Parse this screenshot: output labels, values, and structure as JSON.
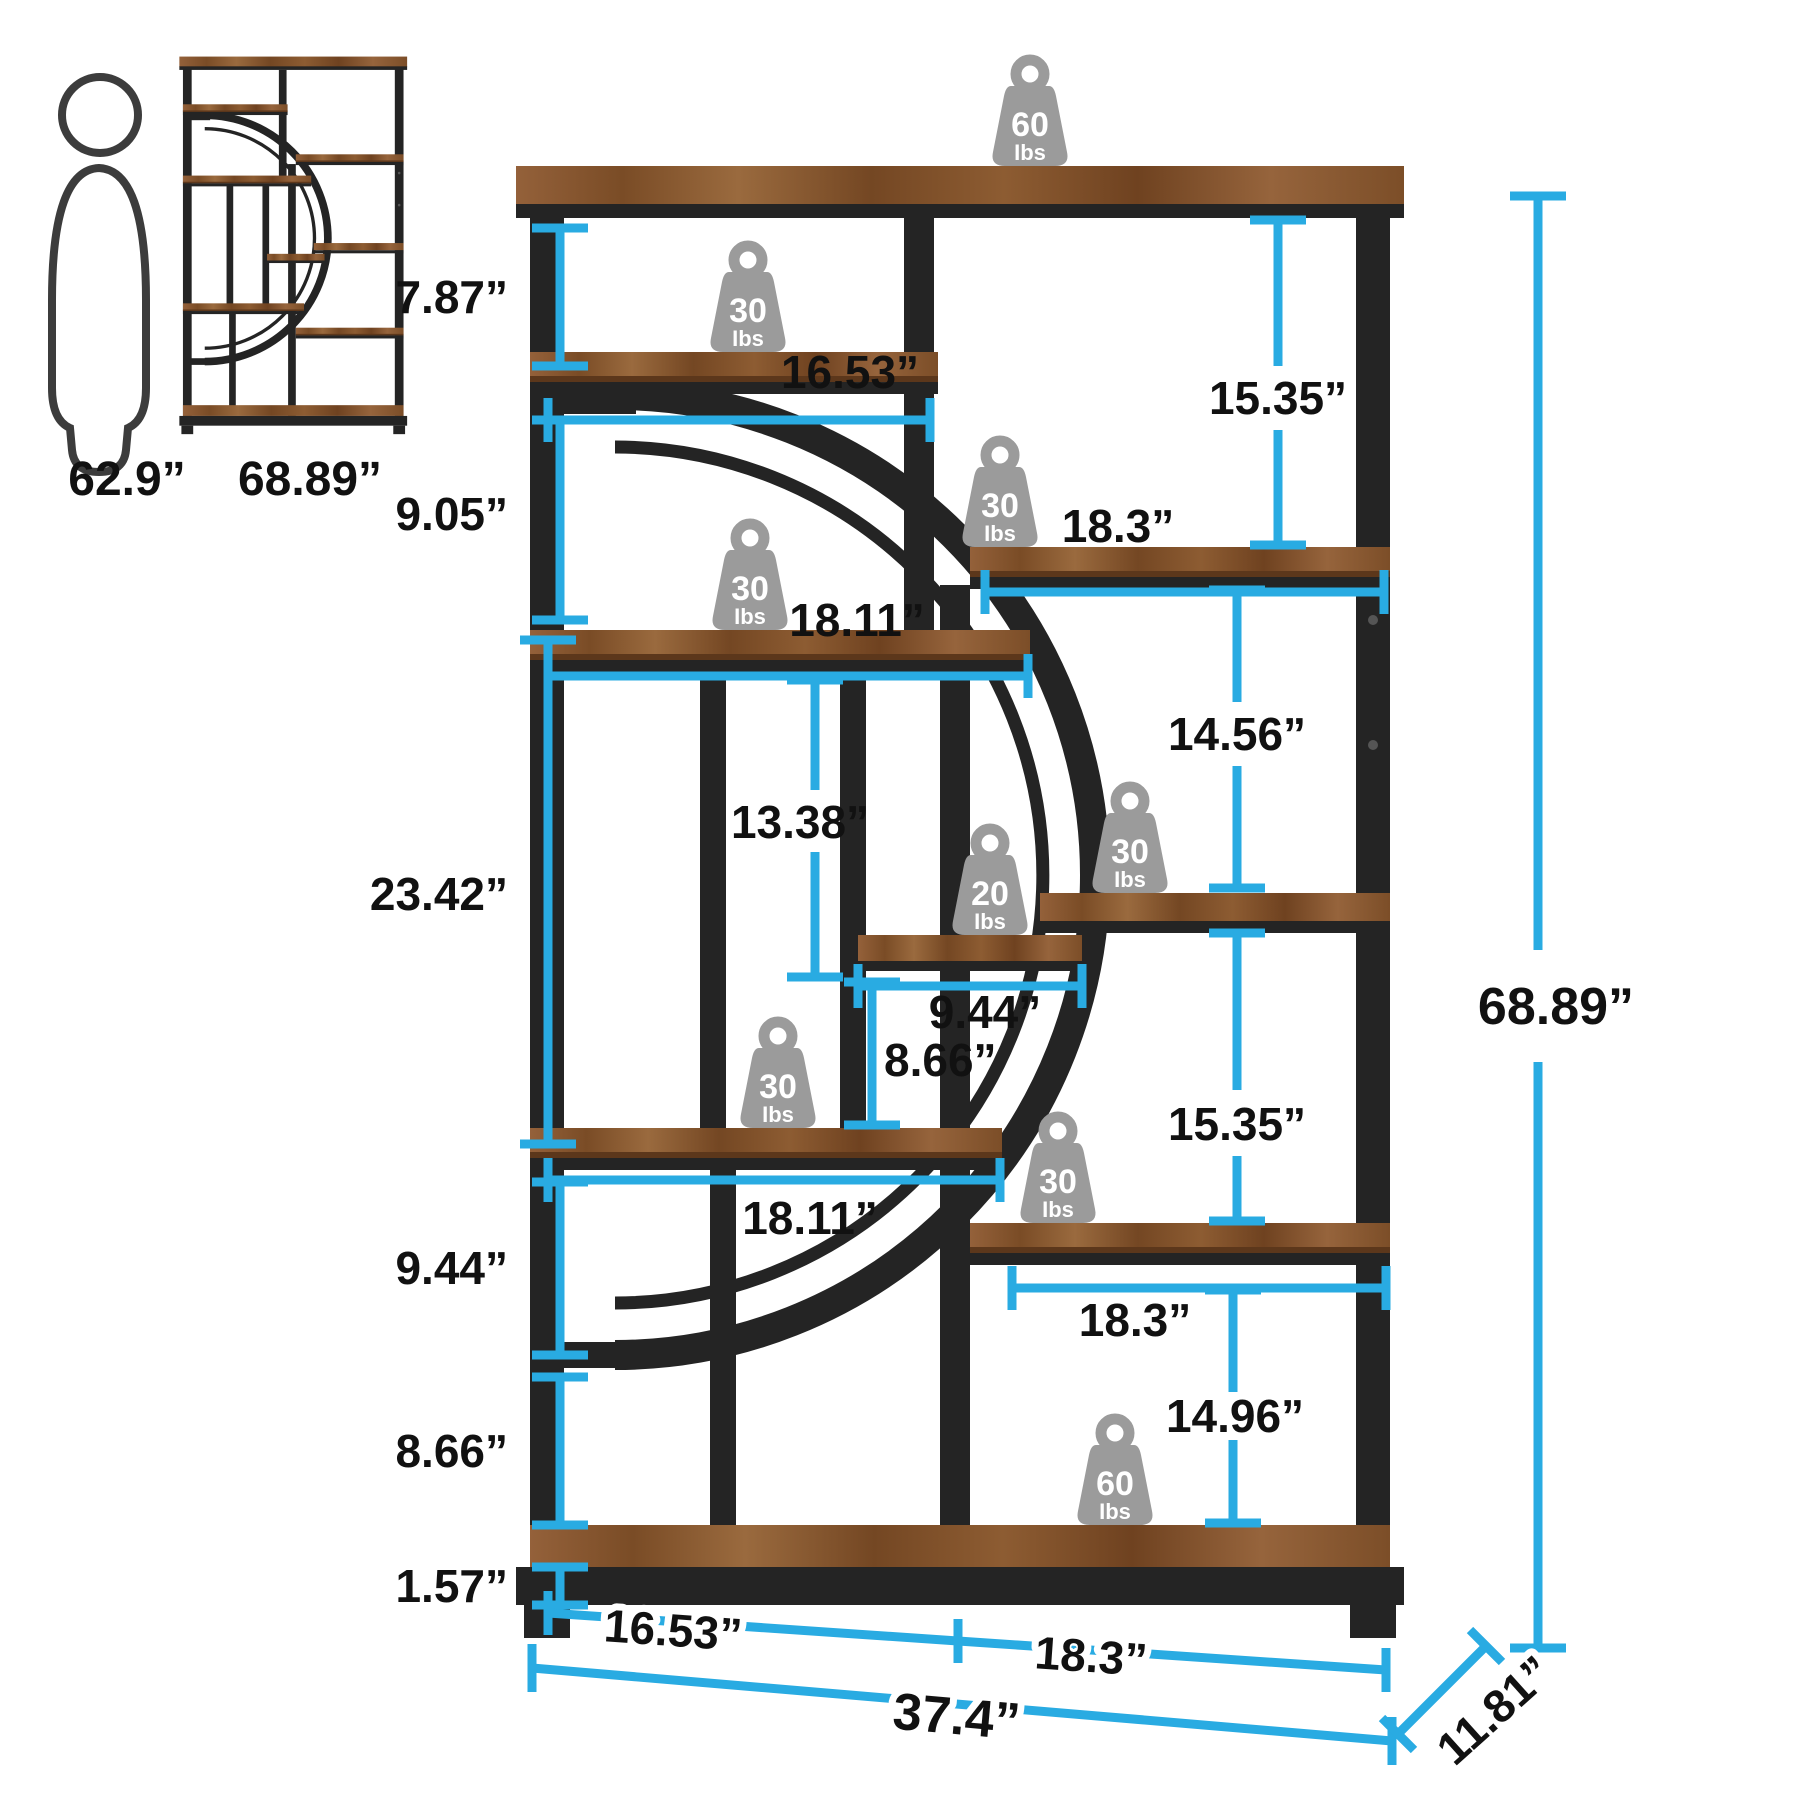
{
  "reference": {
    "person_height_label": "62.9”",
    "thumbnail_height_label": "68.89”"
  },
  "load_capacities": {
    "top_shelf": {
      "value": "60",
      "unit": "Ibs"
    },
    "shelf_a": {
      "value": "30",
      "unit": "Ibs"
    },
    "shelf_b": {
      "value": "30",
      "unit": "Ibs"
    },
    "shelf_c": {
      "value": "30",
      "unit": "Ibs"
    },
    "shelf_d_small щ": {
      "value": "20",
      "unit": "Ibs"
    },
    "shelf_d_small": {
      "value": "20",
      "unit": "Ibs"
    },
    "shelf_e": {
      "value": "30",
      "unit": "Ibs"
    },
    "shelf_f": {
      "value": "30",
      "unit": "Ibs"
    },
    "shelf_g": {
      "value": "30",
      "unit": "Ibs"
    },
    "bottom_shelf": {
      "value": "60",
      "unit": "Ibs"
    }
  },
  "dimensions": {
    "gap_top": "7.87”",
    "gap_second": "9.05”",
    "gap_large_left": "23.42”",
    "gap_left_lower": "9.44”",
    "gap_left_bottom": "8.66”",
    "base_height": "1.57”",
    "shelf_a_width": "16.53”",
    "shelf_b_width": "18.3”",
    "shelf_c_width": "18.11”",
    "gap_mid_column": "13.38”",
    "gap_right_upper": "15.35”",
    "gap_right_mid": "14.56”",
    "small_shelf_width": "9.44”",
    "gap_mid_lower": "8.66”",
    "shelf_f_width": "18.11”",
    "gap_right_lower": "15.35”",
    "shelf_g_width": "18.3”",
    "gap_right_bottom": "14.96”",
    "bottom_left_width": "16.53”",
    "bottom_right_width": "18.3”",
    "total_width": "37.4”",
    "depth": "11.81”",
    "total_height": "68.89”"
  },
  "colors": {
    "accent_cyan": "#29ABE2",
    "frame_black": "#242424",
    "wood_brown": "#8a5a30",
    "weight_gray": "#9b9b9b",
    "label_black": "#111111"
  }
}
